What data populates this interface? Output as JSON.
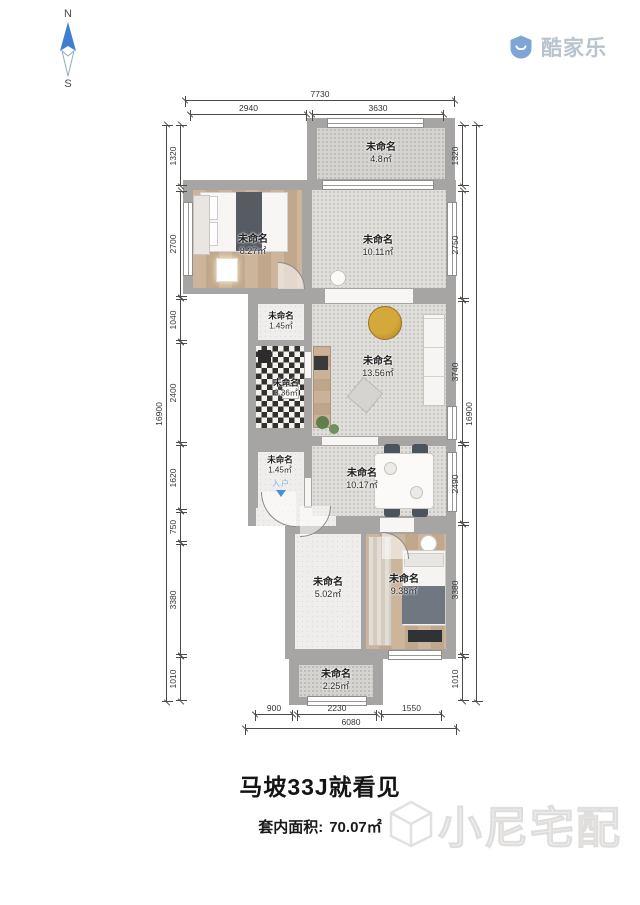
{
  "compass": {
    "north": "N",
    "south": "S"
  },
  "brand": {
    "name": "酷家乐"
  },
  "rooms": [
    {
      "name": "未命名",
      "area": "4.8㎡"
    },
    {
      "name": "未命名",
      "area": "8.27㎡"
    },
    {
      "name": "未命名",
      "area": "10.11㎡"
    },
    {
      "name": "未命名",
      "area": "1.45㎡"
    },
    {
      "name": "未命名",
      "area": "3.36㎡"
    },
    {
      "name": "未命名",
      "area": "13.56㎡"
    },
    {
      "name": "未命名",
      "area": "1.45㎡"
    },
    {
      "name": "未命名",
      "area": "10.17㎡"
    },
    {
      "name": "未命名",
      "area": "5.02㎡"
    },
    {
      "name": "未命名",
      "area": "9.38㎡"
    },
    {
      "name": "未命名",
      "area": "2.25㎡"
    }
  ],
  "entry": {
    "label": "入户"
  },
  "dimensions": {
    "top": {
      "overall": "7730",
      "segments": [
        "2940",
        "3630"
      ]
    },
    "bottom": {
      "overall": "6080",
      "segments": [
        "900",
        "2230",
        "1550"
      ]
    },
    "left": {
      "overall": "16900",
      "segments": [
        "1320",
        "2700",
        "1040",
        "2400",
        "1620",
        "750",
        "3380",
        "1010"
      ]
    },
    "right": {
      "overall": "16900",
      "segments": [
        "1320",
        "2750",
        "3740",
        "2490",
        "3380",
        "1010"
      ]
    }
  },
  "footer": {
    "title": "马坡33J就看见",
    "area_label": "套内面积:",
    "area_value": "70.07㎡"
  },
  "watermark": {
    "text": "小尼宅配"
  }
}
